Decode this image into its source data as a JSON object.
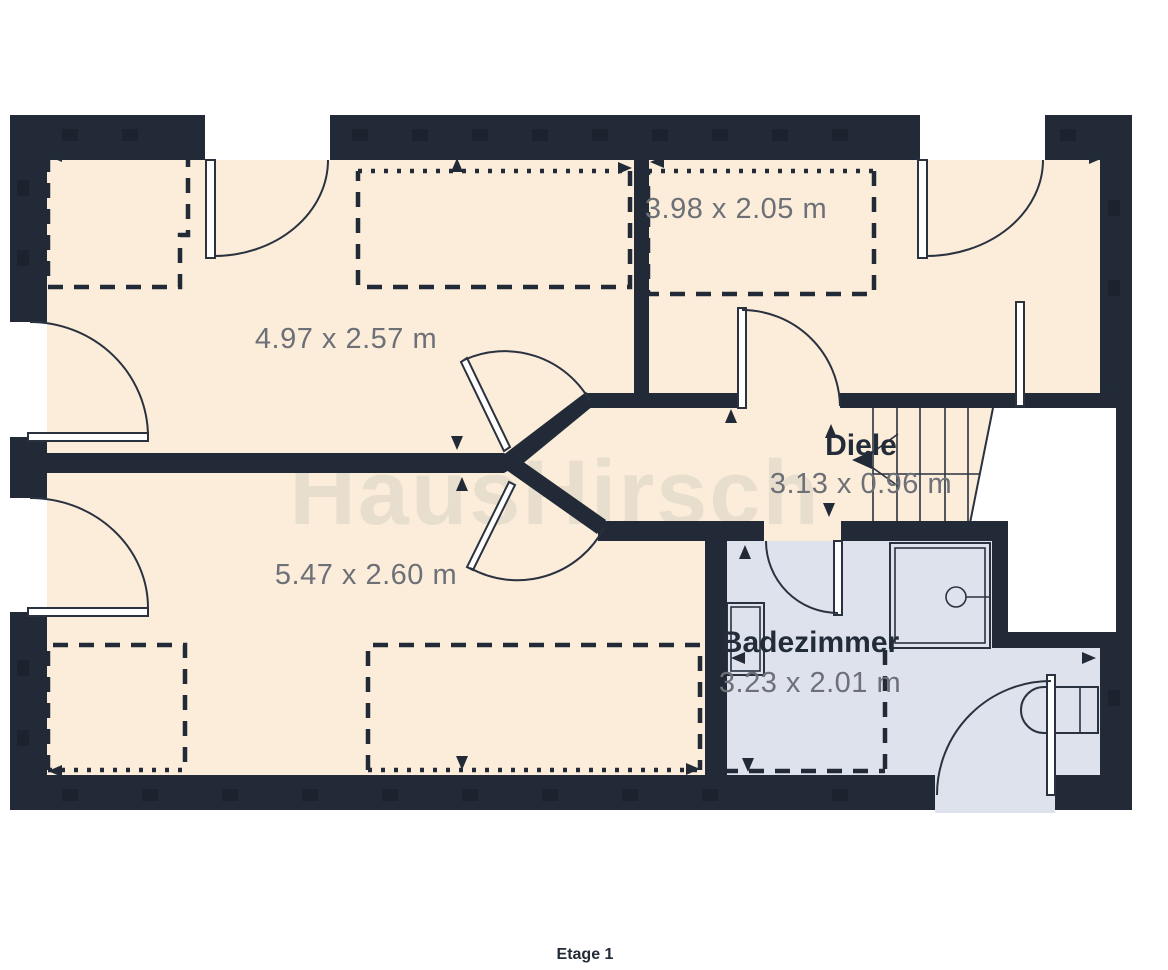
{
  "title": "Etage 1",
  "watermark": "HausHirsch",
  "rooms": [
    {
      "name": "",
      "dims": "4.97 x 2.57 m"
    },
    {
      "name": "",
      "dims": "3.98 x 2.05 m"
    },
    {
      "name": "",
      "dims": "5.47 x 2.60 m"
    },
    {
      "name": "Diele",
      "dims": "3.13 x 0.96 m"
    },
    {
      "name": "Badezimmer",
      "dims": "3.23 x 2.01 m"
    }
  ],
  "colors": {
    "wall": "#212a36",
    "room_floor": "#fcedda",
    "bath_floor": "#dee2ed",
    "dim_text": "#6d7077",
    "label_text": "#232c39",
    "watermark": "#e8decd",
    "line": "#2a3240",
    "page": "#ffffff"
  }
}
